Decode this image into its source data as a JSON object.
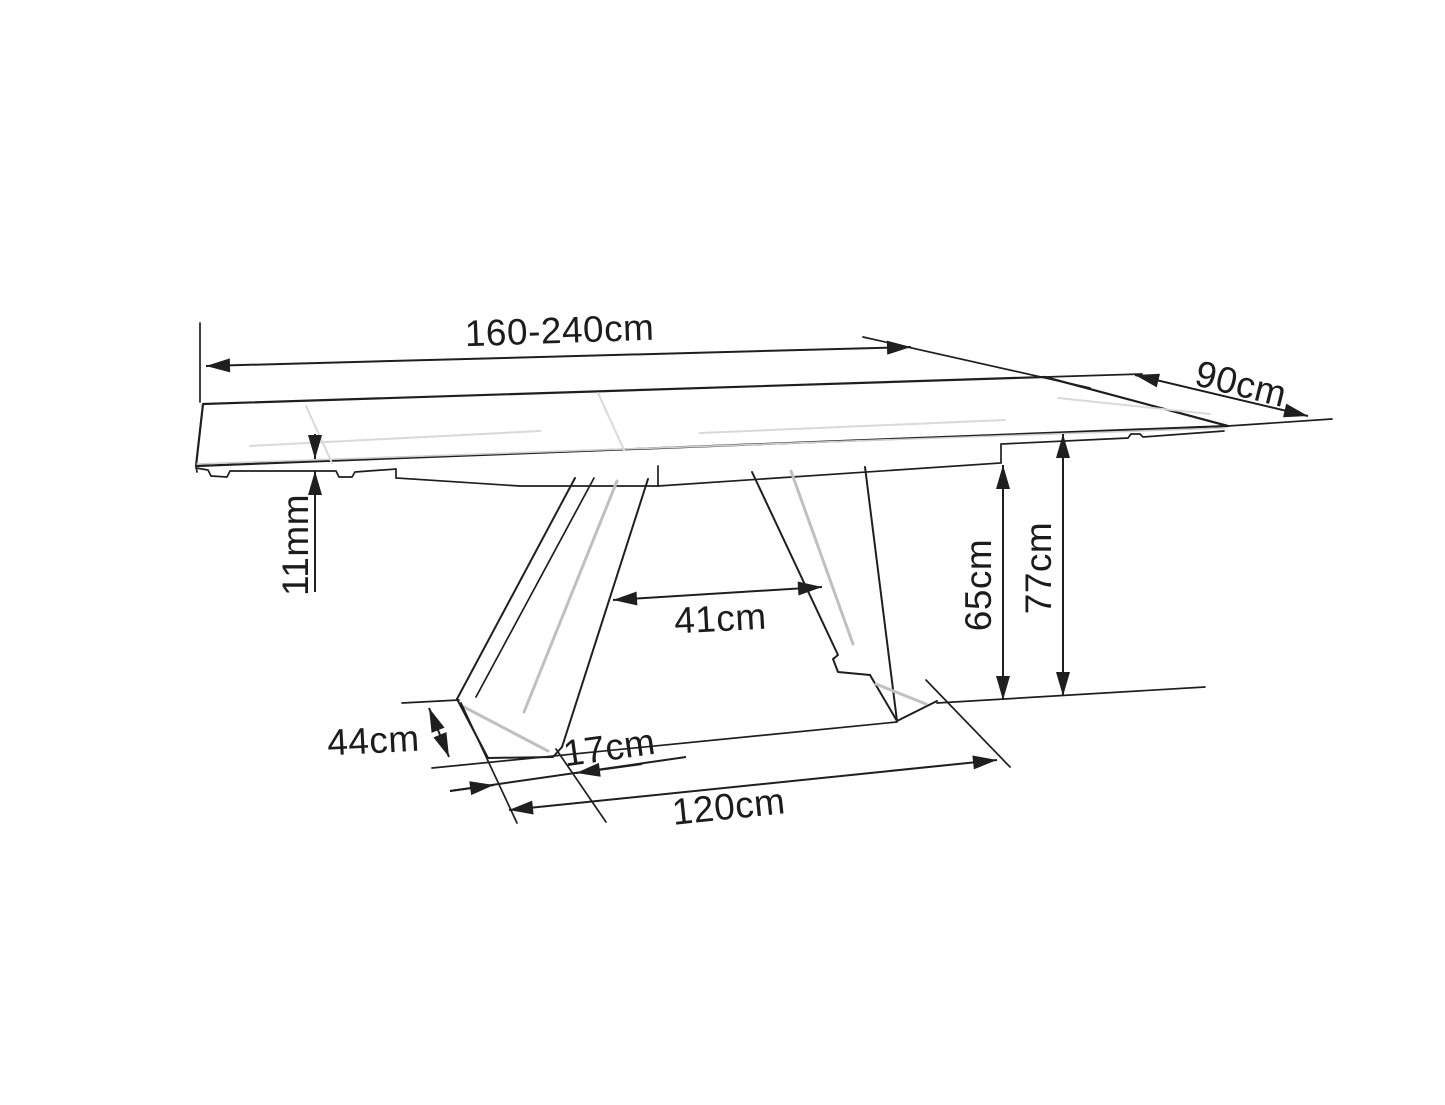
{
  "colors": {
    "background": "#ffffff",
    "line": "#1f1f1f",
    "shading": "#c0c0c0"
  },
  "diagram": {
    "type": "furniture-dimension-drawing",
    "dimensions": {
      "length": "160-240cm",
      "depth": "90cm",
      "top_thickness": "11mm",
      "leg_clearance": "41cm",
      "underframe_height": "65cm",
      "table_height": "77cm",
      "foot_length": "44cm",
      "foot_width": "17cm",
      "base_span": "120cm"
    }
  }
}
